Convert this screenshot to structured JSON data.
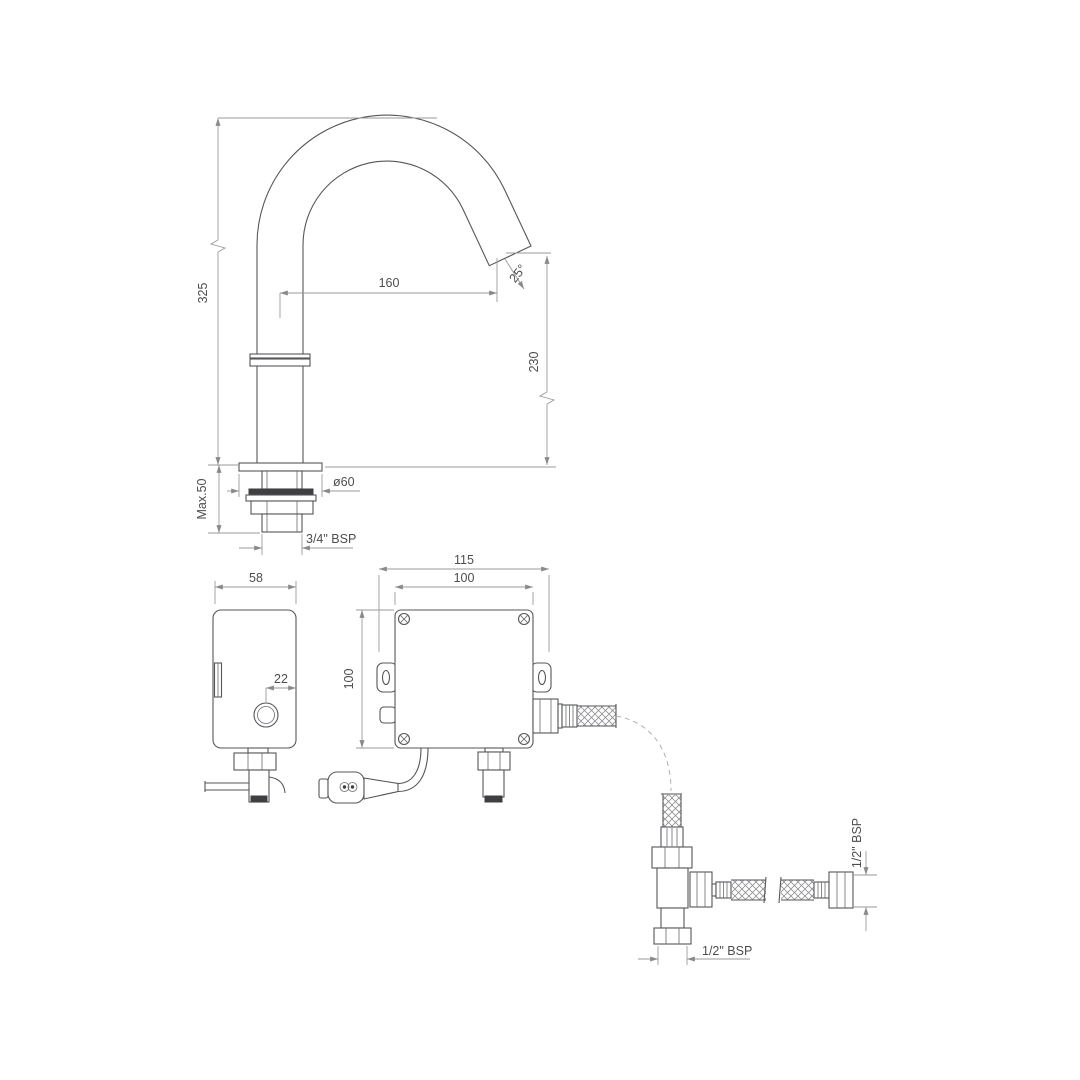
{
  "labels": {
    "spout_height": "325",
    "spout_reach": "160",
    "spout_angle": "25°",
    "outlet_height": "230",
    "deck_thickness": "Max.50",
    "base_diameter": "ø60",
    "base_thread": "3/4\" BSP",
    "box_depth": "58",
    "button_offset": "22",
    "box_overall_width": "115",
    "box_body_width": "100",
    "box_height": "100",
    "inlet_thread_right": "1/2\" BSP",
    "inlet_thread_bottom": "1/2\" BSP"
  }
}
